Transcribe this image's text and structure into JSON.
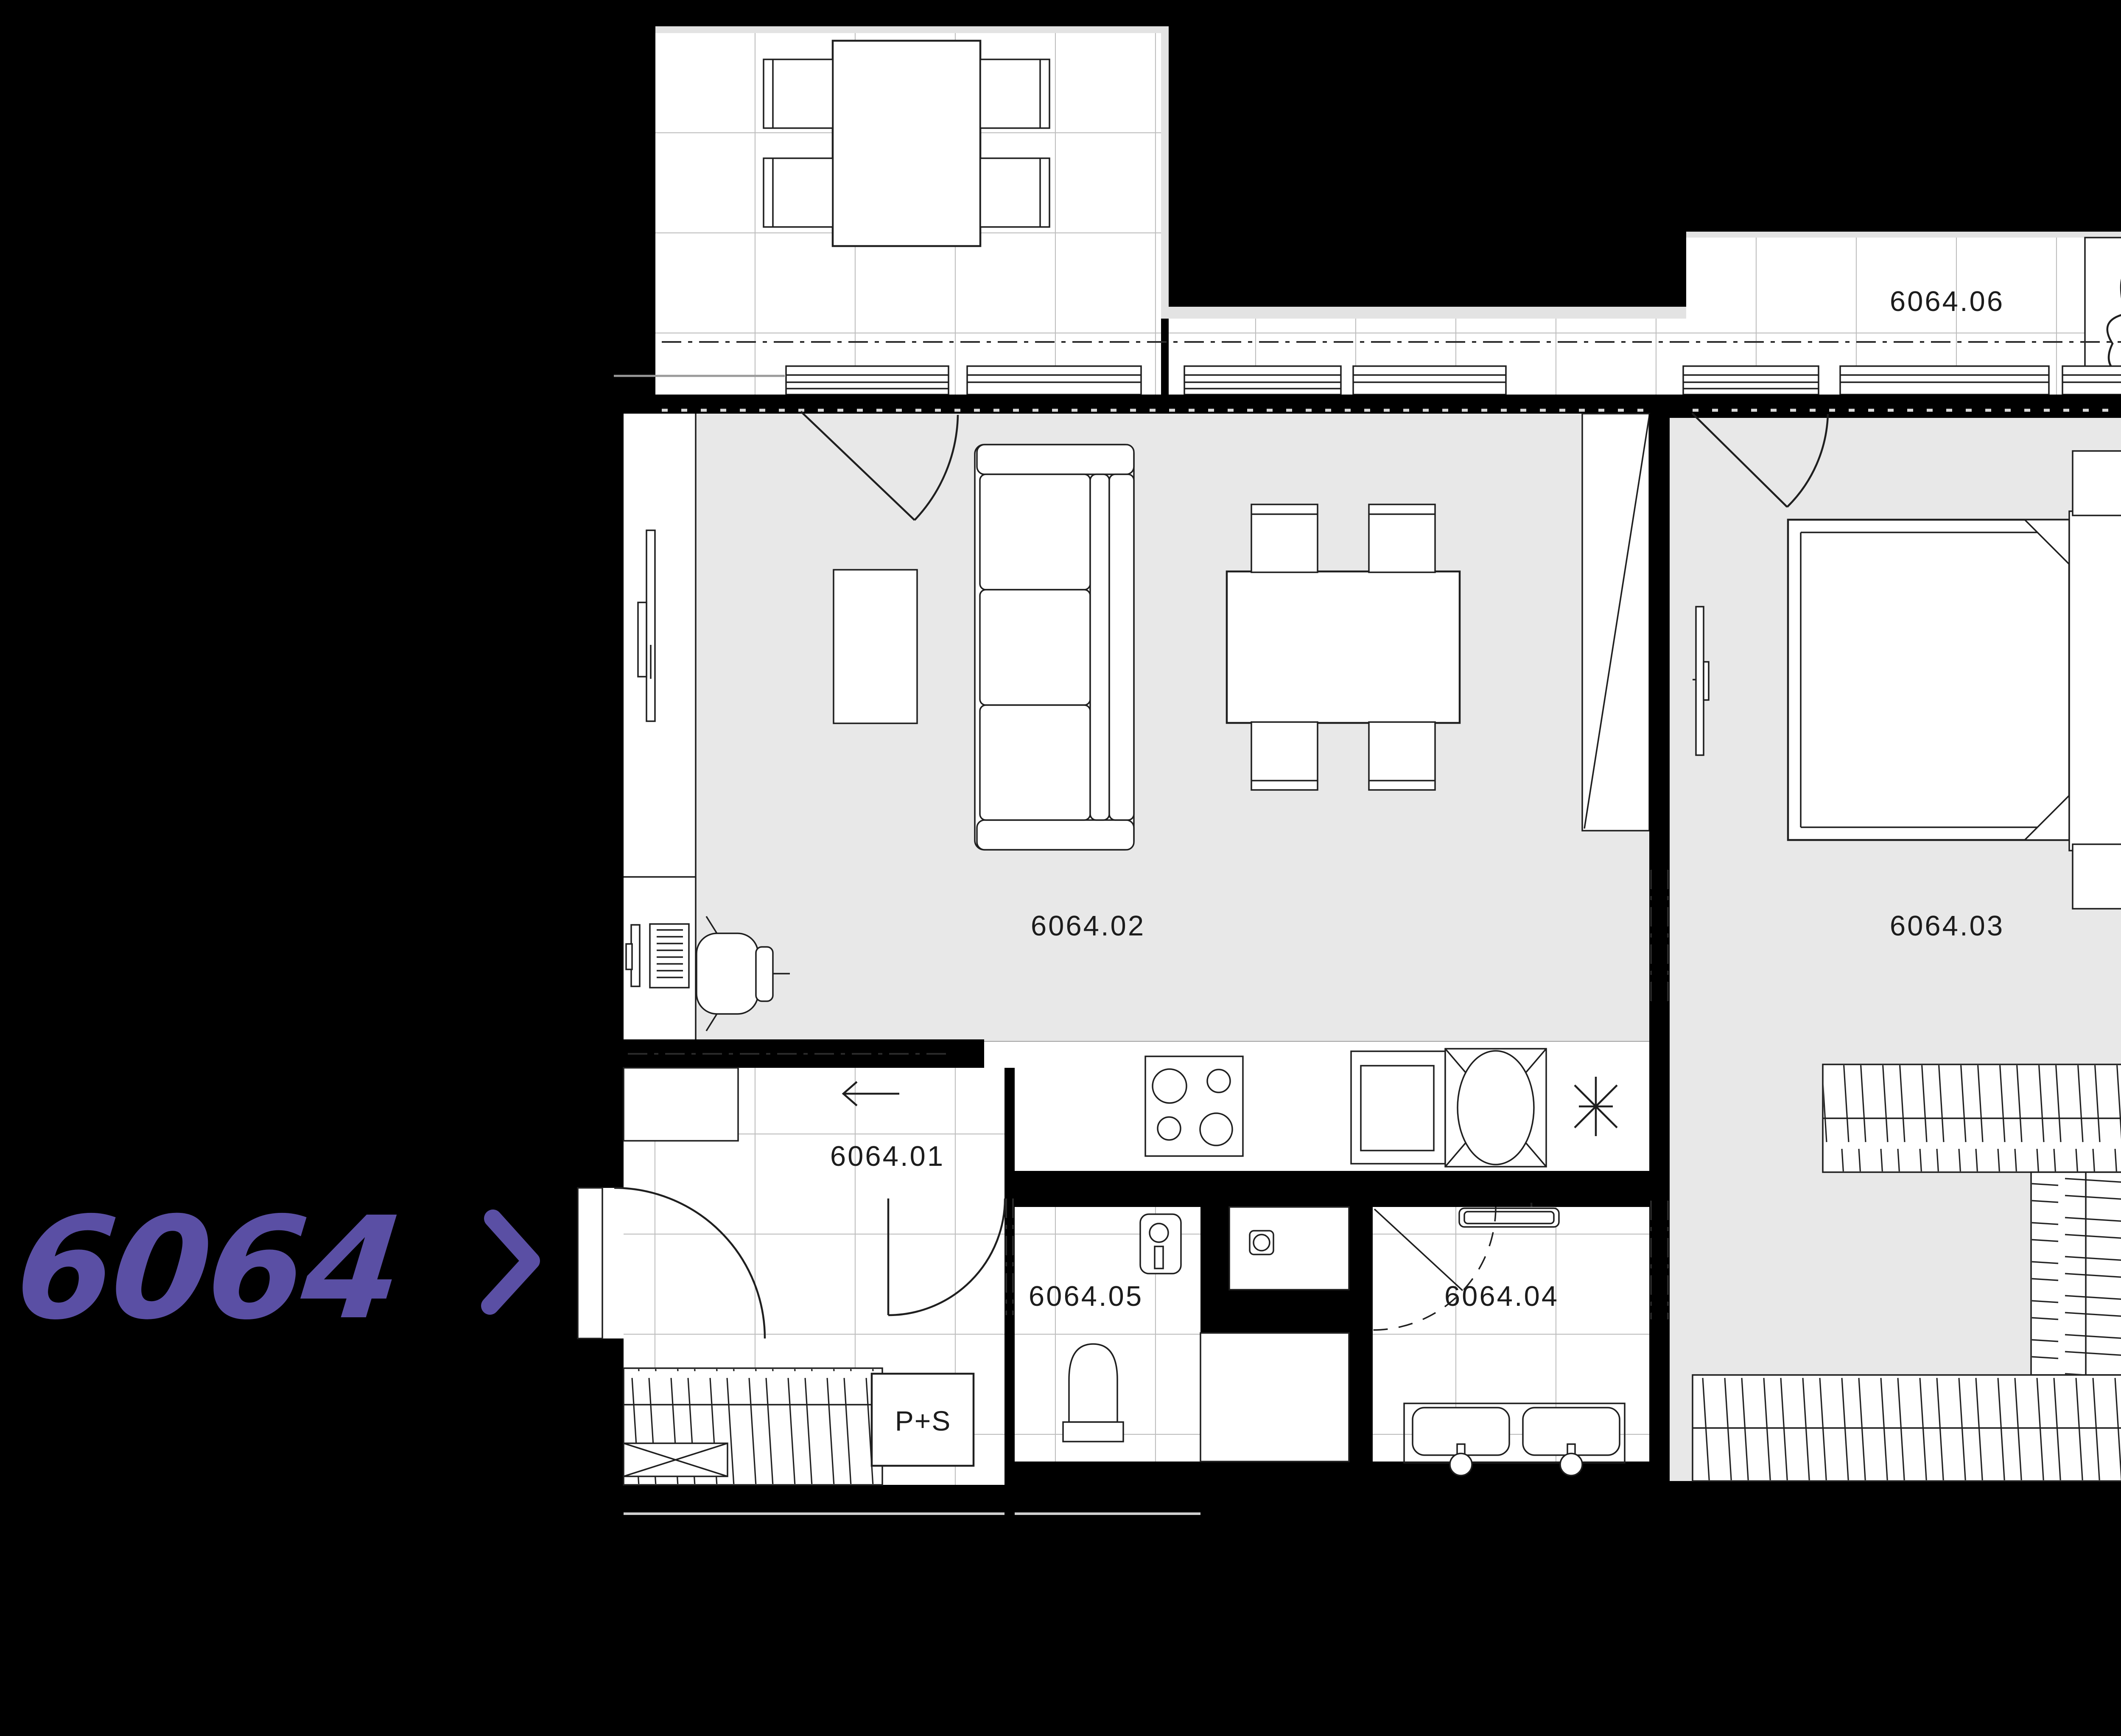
{
  "plan": {
    "type": "apartment-floor-plan",
    "unit_label": {
      "number": "6064",
      "pointer_icon": "chevron-right"
    },
    "room_labels": [
      {
        "label": "6064.01",
        "role": "entrance-hall"
      },
      {
        "label": "6064.02",
        "role": "living-room-kitchen"
      },
      {
        "label": "6064.03",
        "role": "bedroom"
      },
      {
        "label": "6064.04",
        "role": "bathroom"
      },
      {
        "label": "6064.05",
        "role": "wc"
      },
      {
        "label": "6064.06",
        "role": "balcony"
      }
    ],
    "corridor": {
      "washer_dryer_label": "P+S",
      "entry_direction_icon": "arrow-left"
    },
    "icons": {
      "unit_pointer": "chevron-right",
      "entry_direction": "arrow-left",
      "plant": "plant-blob",
      "hob": "four-burner-circles",
      "sink": "basin-rect",
      "appliance": "x-cross-ellipse",
      "light_point": "asterisk"
    },
    "colors": {
      "background": "#000000",
      "room_floor_gray": "#e8e8e8",
      "room_floor_white": "#ffffff",
      "light_edge": "#e3e3e3",
      "wall": "#000000",
      "line": "#1f1f1f",
      "tile_grid": "#bdbdbd",
      "accent_purple": "#5a4fa4",
      "label_text": "#1c1c1c"
    }
  }
}
